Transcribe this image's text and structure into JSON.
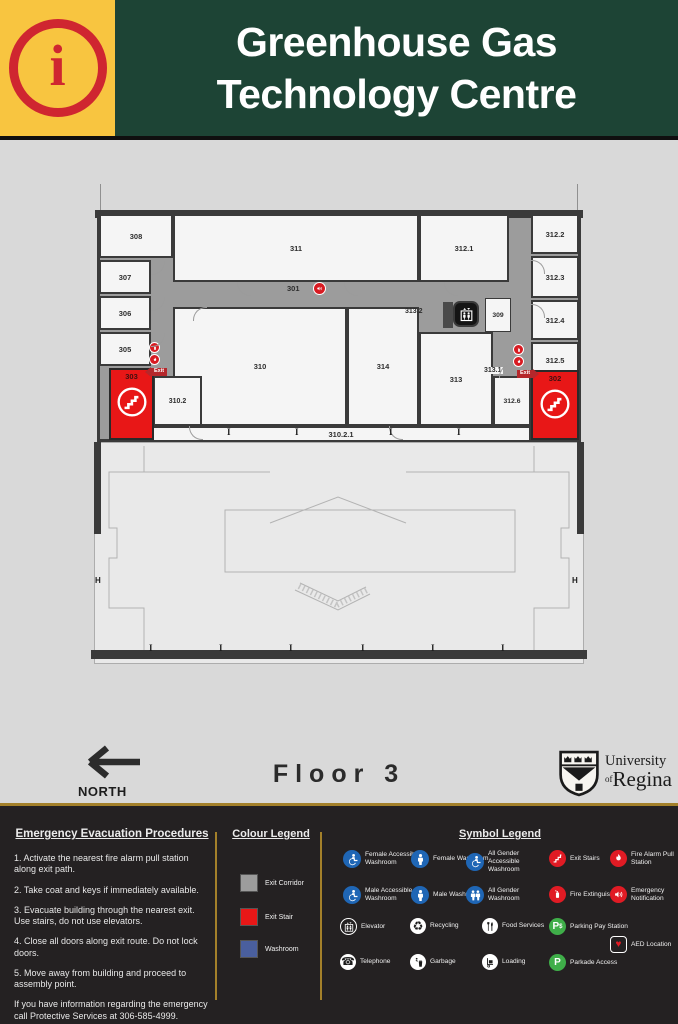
{
  "header": {
    "info_symbol": "i",
    "title_line1": "Greenhouse Gas",
    "title_line2": "Technology Centre"
  },
  "plan": {
    "rooms": [
      {
        "label": "308"
      },
      {
        "label": "307"
      },
      {
        "label": "306"
      },
      {
        "label": "305"
      },
      {
        "label": "303"
      },
      {
        "label": "311"
      },
      {
        "label": "312.1"
      },
      {
        "label": "312.2"
      },
      {
        "label": "312.3"
      },
      {
        "label": "301"
      },
      {
        "label": "312.4"
      },
      {
        "label": "312.5"
      },
      {
        "label": "313.2"
      },
      {
        "label": "309"
      },
      {
        "label": "310"
      },
      {
        "label": "314"
      },
      {
        "label": "313"
      },
      {
        "label": "313.1"
      },
      {
        "label": "302"
      },
      {
        "label": "310.2"
      },
      {
        "label": "312.6"
      },
      {
        "label": "310.2.1"
      }
    ],
    "exit_label": "Exit",
    "grid_label_left": "H",
    "grid_label_right": "H"
  },
  "bottom_band": {
    "north_label": "NORTH",
    "floor_label": "Floor 3",
    "logo": {
      "university": "University",
      "of": "of",
      "regina": "Regina"
    }
  },
  "footer": {
    "procedures": {
      "title": "Emergency Evacuation Procedures",
      "steps": [
        "1. Activate the nearest fire alarm pull station along exit path.",
        "2. Take coat and keys if immediately available.",
        "3. Evacuate building through the nearest exit. Use stairs, do not use elevators.",
        "4. Close all doors along exit route. Do not lock doors.",
        "5. Move away from building and proceed to assembly point."
      ],
      "note": "If you have information regarding the emergency call Protective Services at 306-585-4999."
    },
    "colour_legend": {
      "title": "Colour Legend",
      "items": [
        {
          "label": "Exit Corridor",
          "color": "#9c9c9c"
        },
        {
          "label": "Exit Stair",
          "color": "#e81717"
        },
        {
          "label": "Washroom",
          "color": "#4a5f9e"
        }
      ]
    },
    "symbol_legend": {
      "title": "Symbol Legend",
      "items": [
        {
          "icon": "female-accessible-washroom-icon",
          "label": "Female Accessible Washroom"
        },
        {
          "icon": "female-washroom-icon",
          "label": "Female Washroom"
        },
        {
          "icon": "all-gender-accessible-washroom-icon",
          "label": "All Gender Accessible Washroom"
        },
        {
          "icon": "exit-stairs-icon",
          "label": "Exit Stairs"
        },
        {
          "icon": "fire-alarm-pull-station-icon",
          "label": "Fire Alarm Pull Station"
        },
        {
          "icon": "male-accessible-washroom-icon",
          "label": "Male Accessible Washroom"
        },
        {
          "icon": "male-washroom-icon",
          "label": "Male Washroom"
        },
        {
          "icon": "all-gender-washroom-icon",
          "label": "All Gender Washroom"
        },
        {
          "icon": "fire-extinguisher-icon",
          "label": "Fire Extinguisher"
        },
        {
          "icon": "emergency-notification-icon",
          "label": "Emergency Notification"
        },
        {
          "icon": "elevator-icon",
          "label": "Elevator"
        },
        {
          "icon": "recycling-icon",
          "label": "Recycling"
        },
        {
          "icon": "food-services-icon",
          "label": "Food Services"
        },
        {
          "icon": "parking-pay-station-icon",
          "label": "Parking Pay Station"
        },
        {
          "icon": "aed-location-icon",
          "label": "AED Location"
        },
        {
          "icon": "telephone-icon",
          "label": "Telephone"
        },
        {
          "icon": "garbage-icon",
          "label": "Garbage"
        },
        {
          "icon": "loading-icon",
          "label": "Loading"
        },
        {
          "icon": "parkade-access-icon",
          "label": "Parkade Access"
        }
      ]
    }
  },
  "colors": {
    "header_green": "#1d4435",
    "header_yellow": "#f8c540",
    "accent_gold": "#a3802a",
    "exit_red": "#e81717",
    "corridor_gray": "#9c9c9c",
    "washroom_blue": "#4a5f9e",
    "icon_blue": "#1f66b5",
    "icon_red": "#e01b24",
    "icon_green": "#3fae49",
    "footer_bg": "#242122"
  }
}
